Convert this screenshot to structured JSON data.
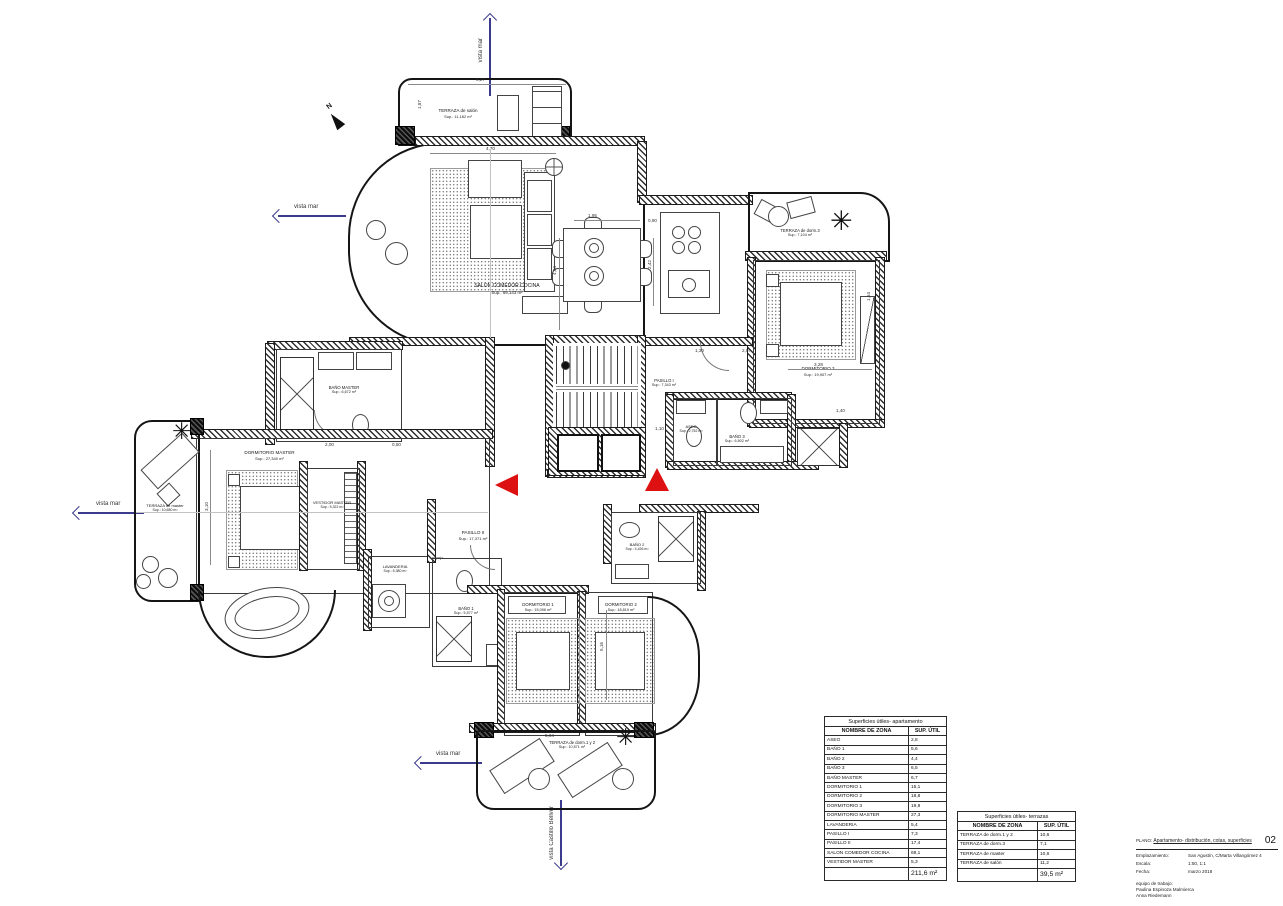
{
  "meta": {
    "north_label": "N"
  },
  "arrows": {
    "top": "vista mar",
    "upper_left": "vista mar",
    "left": "vista mar",
    "lower_left": "vista mar",
    "bottom": "vista Castillo Bellver"
  },
  "rooms": {
    "terraza_salon": {
      "name": "TERRAZA de salón",
      "sup": "Sup.: 11,182 m²"
    },
    "salon": {
      "name": "SALON COMEDOR COCINA",
      "sup": "Sup.: 69,143 m²"
    },
    "terraza_dorm3": {
      "name": "TERRAZA de dorm.3",
      "sup": "Sup.: 7,104 m²"
    },
    "dormitorio3": {
      "name": "DORMITORIO 3",
      "sup": "Sup.: 19,907 m²"
    },
    "pasillo1": {
      "name": "PASILLO I",
      "sup": "Sup.: 7,343 m²"
    },
    "aseo": {
      "name": "ASEO",
      "sup": "Sup.: 2,752 m²"
    },
    "bano3": {
      "name": "BAÑO 3",
      "sup": "Sup.: 6,502 m²"
    },
    "bano_master": {
      "name": "BAÑO MASTER",
      "sup": "Sup.: 6,672 m²"
    },
    "dormitorio_master": {
      "name": "DORMITORIO MASTER",
      "sup": "Sup.: 27,340 m²"
    },
    "terraza_master": {
      "name": "TERRAZA de master",
      "sup": "Sup.: 10,680 m²"
    },
    "vestidor": {
      "name": "VESTIDOR MASTER",
      "sup": "Sup.: 5,322 m²"
    },
    "lavanderia": {
      "name": "LAVANDERIA",
      "sup": "Sup.: 5,380 m²"
    },
    "pasillo2": {
      "name": "PASILLO II",
      "sup": "Sup.: 17,371 m²"
    },
    "bano1": {
      "name": "BAÑO 1",
      "sup": "Sup.: 5,577 m²"
    },
    "bano2": {
      "name": "BAÑO 2",
      "sup": "Sup.: 4,426 m²"
    },
    "dormitorio1": {
      "name": "DORMITORIO 1",
      "sup": "Sup.: 15,096 m²"
    },
    "dormitorio2": {
      "name": "DORMITORIO 2",
      "sup": "Sup.: 18,819 m²"
    },
    "terraza_dorm12": {
      "name": "TERRAZA de dorm.1 y 2",
      "sup": "Sup.: 10,571 m²"
    }
  },
  "annotations": {
    "espejo": "espejo"
  },
  "dims": [
    "6,27",
    "1,87",
    "4,70",
    "1,95",
    "4,04",
    "2,42",
    "0,90",
    "3,28",
    "1,30",
    "5,16",
    "2,07",
    "1,10",
    "3,10",
    "5,04",
    "1,40",
    "2,00",
    "0,50",
    "1,64"
  ],
  "tables": {
    "apartamento": {
      "title": "Superficies útiles- apartamento",
      "col_name": "NOMBRE DE ZONA",
      "col_sup": "SUP. ÚTIL",
      "rows": [
        {
          "name": "ASEO",
          "sup": "2,8"
        },
        {
          "name": "BAÑO 1",
          "sup": "5,6"
        },
        {
          "name": "BAÑO 2",
          "sup": "4,4"
        },
        {
          "name": "BAÑO 3",
          "sup": "6,5"
        },
        {
          "name": "BAÑO MASTER",
          "sup": "6,7"
        },
        {
          "name": "DORMITORIO 1",
          "sup": "15,1"
        },
        {
          "name": "DORMITORIO 2",
          "sup": "18,8"
        },
        {
          "name": "DORMITORIO 3",
          "sup": "19,9"
        },
        {
          "name": "DORMITORIO MASTER",
          "sup": "27,3"
        },
        {
          "name": "LAVANDERIA",
          "sup": "5,4"
        },
        {
          "name": "PASILLO I",
          "sup": "7,3"
        },
        {
          "name": "PASILLO II",
          "sup": "17,4"
        },
        {
          "name": "SALON COMEDOR COCINA",
          "sup": "69,1"
        },
        {
          "name": "VESTIDOR MASTER",
          "sup": "5,3"
        }
      ],
      "total": "211,6 m²"
    },
    "terrazas": {
      "title": "Superficies útiles- terrazas",
      "col_name": "NOMBRE DE ZONA",
      "col_sup": "SUP. ÚTIL",
      "rows": [
        {
          "name": "TERRAZA de dorm.1 y 2",
          "sup": "10,6"
        },
        {
          "name": "TERRAZA de dorm.3",
          "sup": "7,1"
        },
        {
          "name": "TERRAZA de master",
          "sup": "10,6"
        },
        {
          "name": "TERRAZA de salón",
          "sup": "11,2"
        }
      ],
      "total": "39,5 m²"
    }
  },
  "title_block": {
    "plano_label": "PLANO:",
    "plano_value": "Apartamento- distribución, cotas, superficies",
    "sheet_number": "02",
    "fields": [
      {
        "label": "Emplazamiento:",
        "value": "San Agustín, C/Marta Villangómez 4"
      },
      {
        "label": "Escala:",
        "value": "1:50, 1:1"
      },
      {
        "label": "Fecha:",
        "value": "marzo 2018"
      }
    ],
    "team_label": "equipo de trabajo:",
    "team_members": [
      "Paulina Espinoza Malmierca",
      "Anna Riedemann"
    ]
  },
  "colors": {
    "arrow": "#3b3b8e",
    "marker_red": "#dd1111"
  }
}
